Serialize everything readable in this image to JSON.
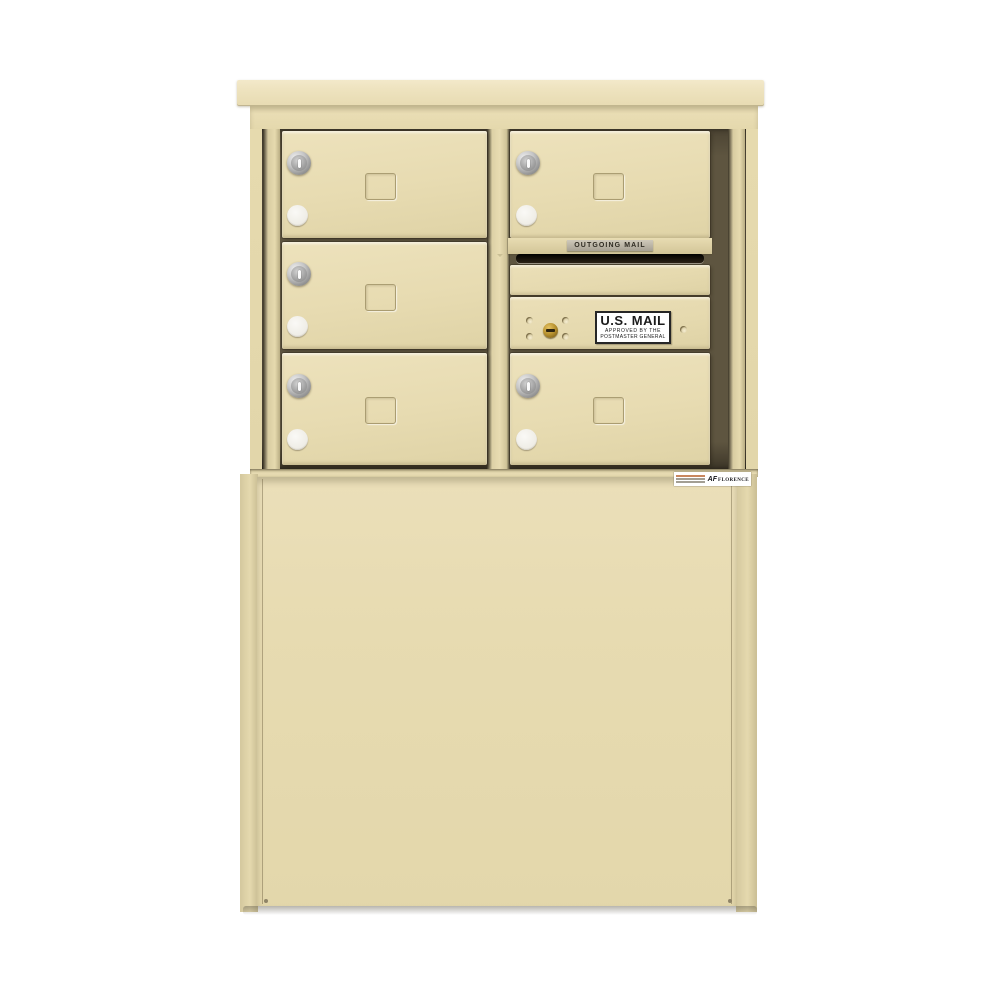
{
  "scene": {
    "description": "Front product photo of a freestanding 4C depot-style cluster mailbox unit with pedestal base, sandalwood finish, on a white background",
    "unit_finish_name": "Sandalwood",
    "background_color": "#ffffff"
  },
  "colors": {
    "sand_base": "#e6daae",
    "sand_light": "#f3e9ca",
    "sand_dark": "#cfc398",
    "recess_dark": "#5e5540",
    "slot_black": "#17110a",
    "plate_gray": "#b5ae9e",
    "lock_silver": "#c6c6c6",
    "lock_brass": "#b8922f",
    "button_white": "#f3f2ed",
    "decal_white": "#ffffff",
    "text_dark": "#2e2a20"
  },
  "labels": {
    "outgoing_mail": "OUTGOING MAIL",
    "us_mail_decal": {
      "line1": "U.S. MAIL",
      "line2": "APPROVED BY THE",
      "line3": "POSTMASTER GENERAL"
    },
    "manufacturer_label": {
      "logo_prefix": "AF",
      "brand": "FLORENCE"
    }
  },
  "components": {
    "tenant_doors": [
      {
        "id": "door-1",
        "column": "left",
        "row": 1,
        "features": [
          "keyed-lock",
          "round-button",
          "card-window"
        ]
      },
      {
        "id": "door-2",
        "column": "left",
        "row": 2,
        "features": [
          "keyed-lock",
          "round-button",
          "card-window"
        ]
      },
      {
        "id": "door-3",
        "column": "left",
        "row": 3,
        "features": [
          "keyed-lock",
          "round-button",
          "card-window"
        ]
      },
      {
        "id": "door-4",
        "column": "right",
        "row": 1,
        "features": [
          "keyed-lock",
          "round-button",
          "card-window"
        ]
      },
      {
        "id": "door-5",
        "column": "right",
        "row": 3,
        "features": [
          "keyed-lock",
          "round-button",
          "card-window"
        ]
      }
    ],
    "outgoing_mail_slot": {
      "label_plate": "OUTGOING MAIL",
      "slot": "dark horizontal opening"
    },
    "filler_panel": {
      "blank": true
    },
    "collection_panel": {
      "decal": "U.S. MAIL",
      "lock": "brass cam lock",
      "rivet_count": 5
    },
    "pedestal_base": {
      "type": "depot cabinet",
      "manufacturer_sticker": "FLORENCE"
    }
  }
}
